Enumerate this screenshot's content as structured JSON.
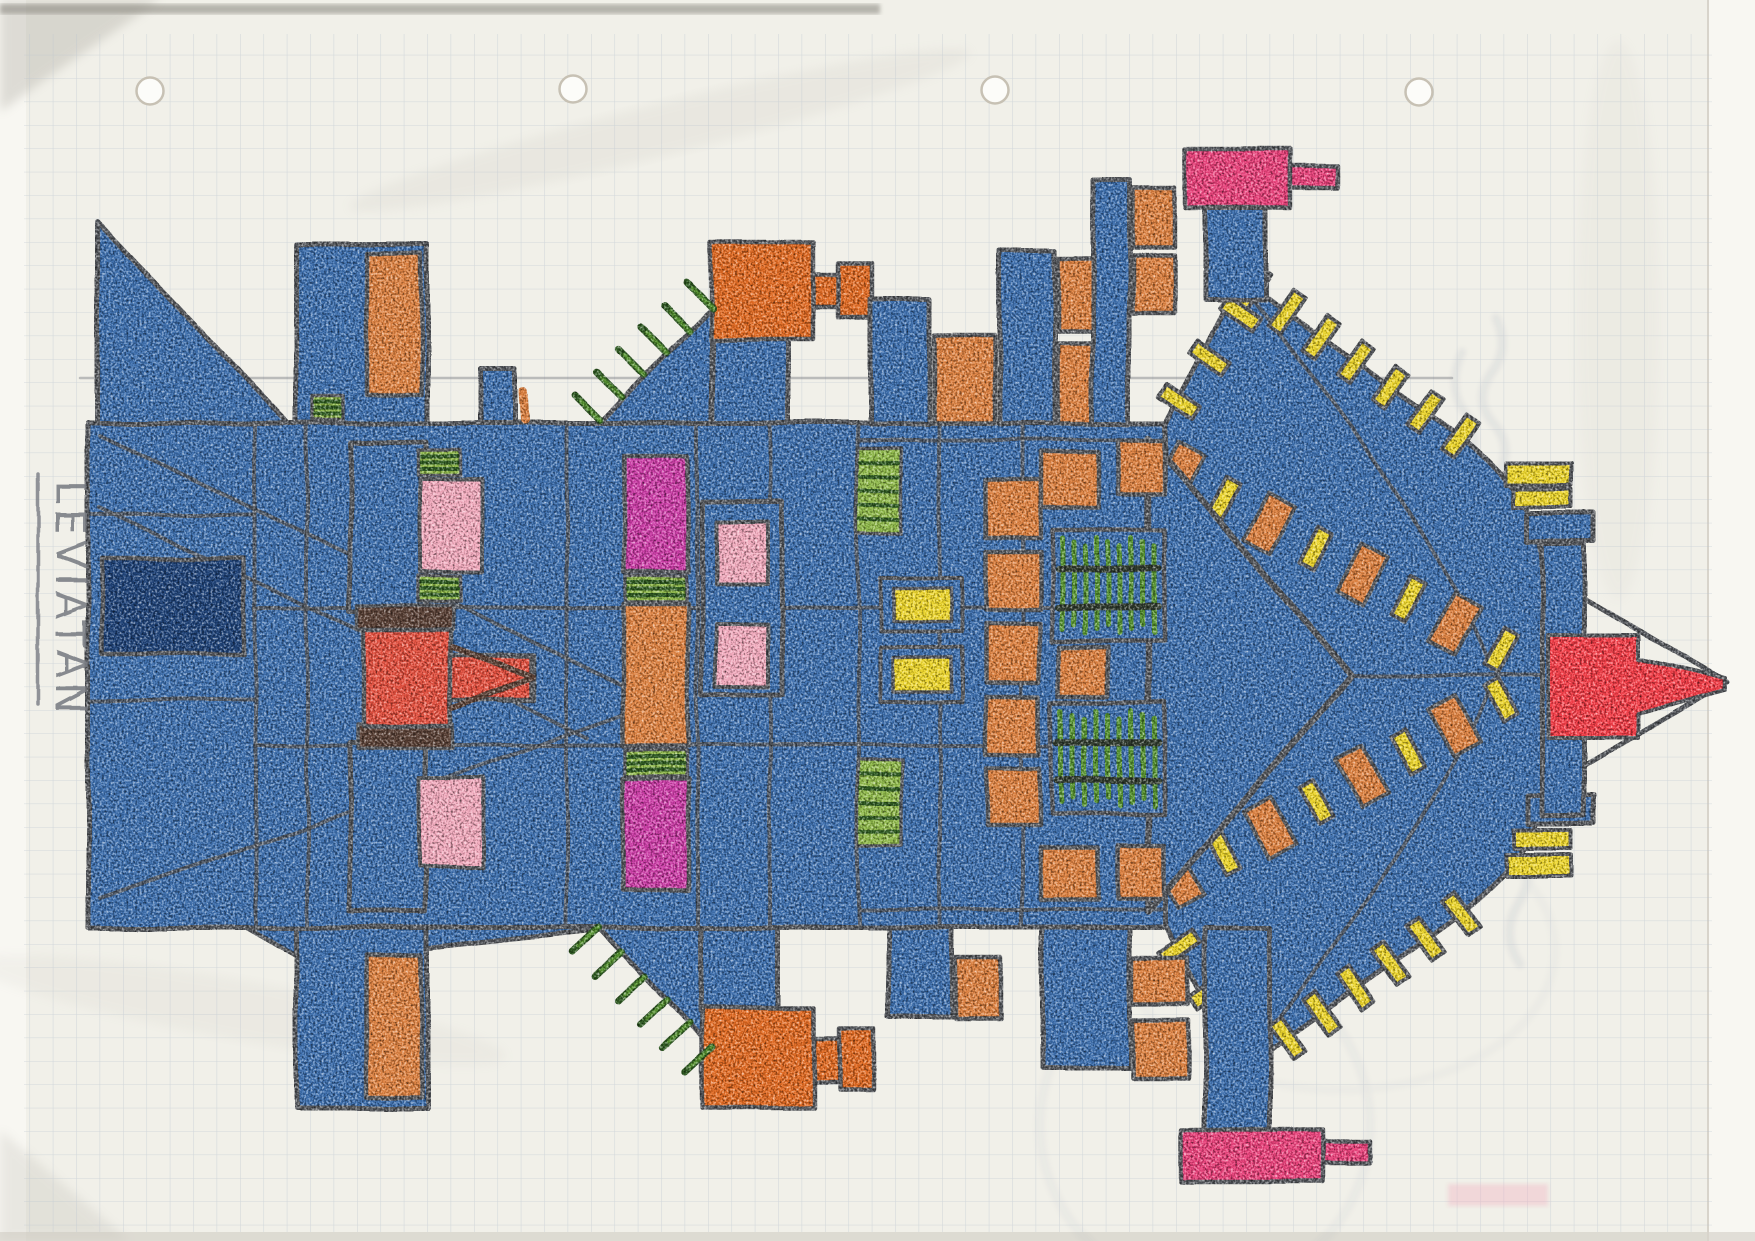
{
  "artwork": {
    "title": "LEVIATAN",
    "subject": "hand-drawn spaceship blueprint, side view, facing right",
    "medium": "colored pencil and crayon on squared graph paper"
  },
  "paper": {
    "type": "graph-paper",
    "punch_hole_count": 4
  },
  "annotations": {
    "bleed_through_writing": "illegible mirrored pencil marks showing through from the reverse side"
  },
  "palette": {
    "paper": "#f1f0e9",
    "paperEdge": "#f8f7f2",
    "grid": "#b7c2ce",
    "pencil": "#787b82",
    "outline": "#54575c",
    "hull": "#3d6fae",
    "hullDark": "#2c5a96",
    "navy": "#1f4379",
    "orange": "#dd8140",
    "orangeDeep": "#e16a22",
    "red": "#e34f3e",
    "redBright": "#f23c46",
    "pinkHot": "#e8417a",
    "pinkLight": "#f1a9bc",
    "magenta": "#cb3ca6",
    "yellow": "#ecd52b",
    "greenLight": "#8fb94a",
    "greenMid": "#55922f",
    "greenDark": "#2e5a21",
    "brown": "#5a4136",
    "bleed": "#99a2b5"
  }
}
